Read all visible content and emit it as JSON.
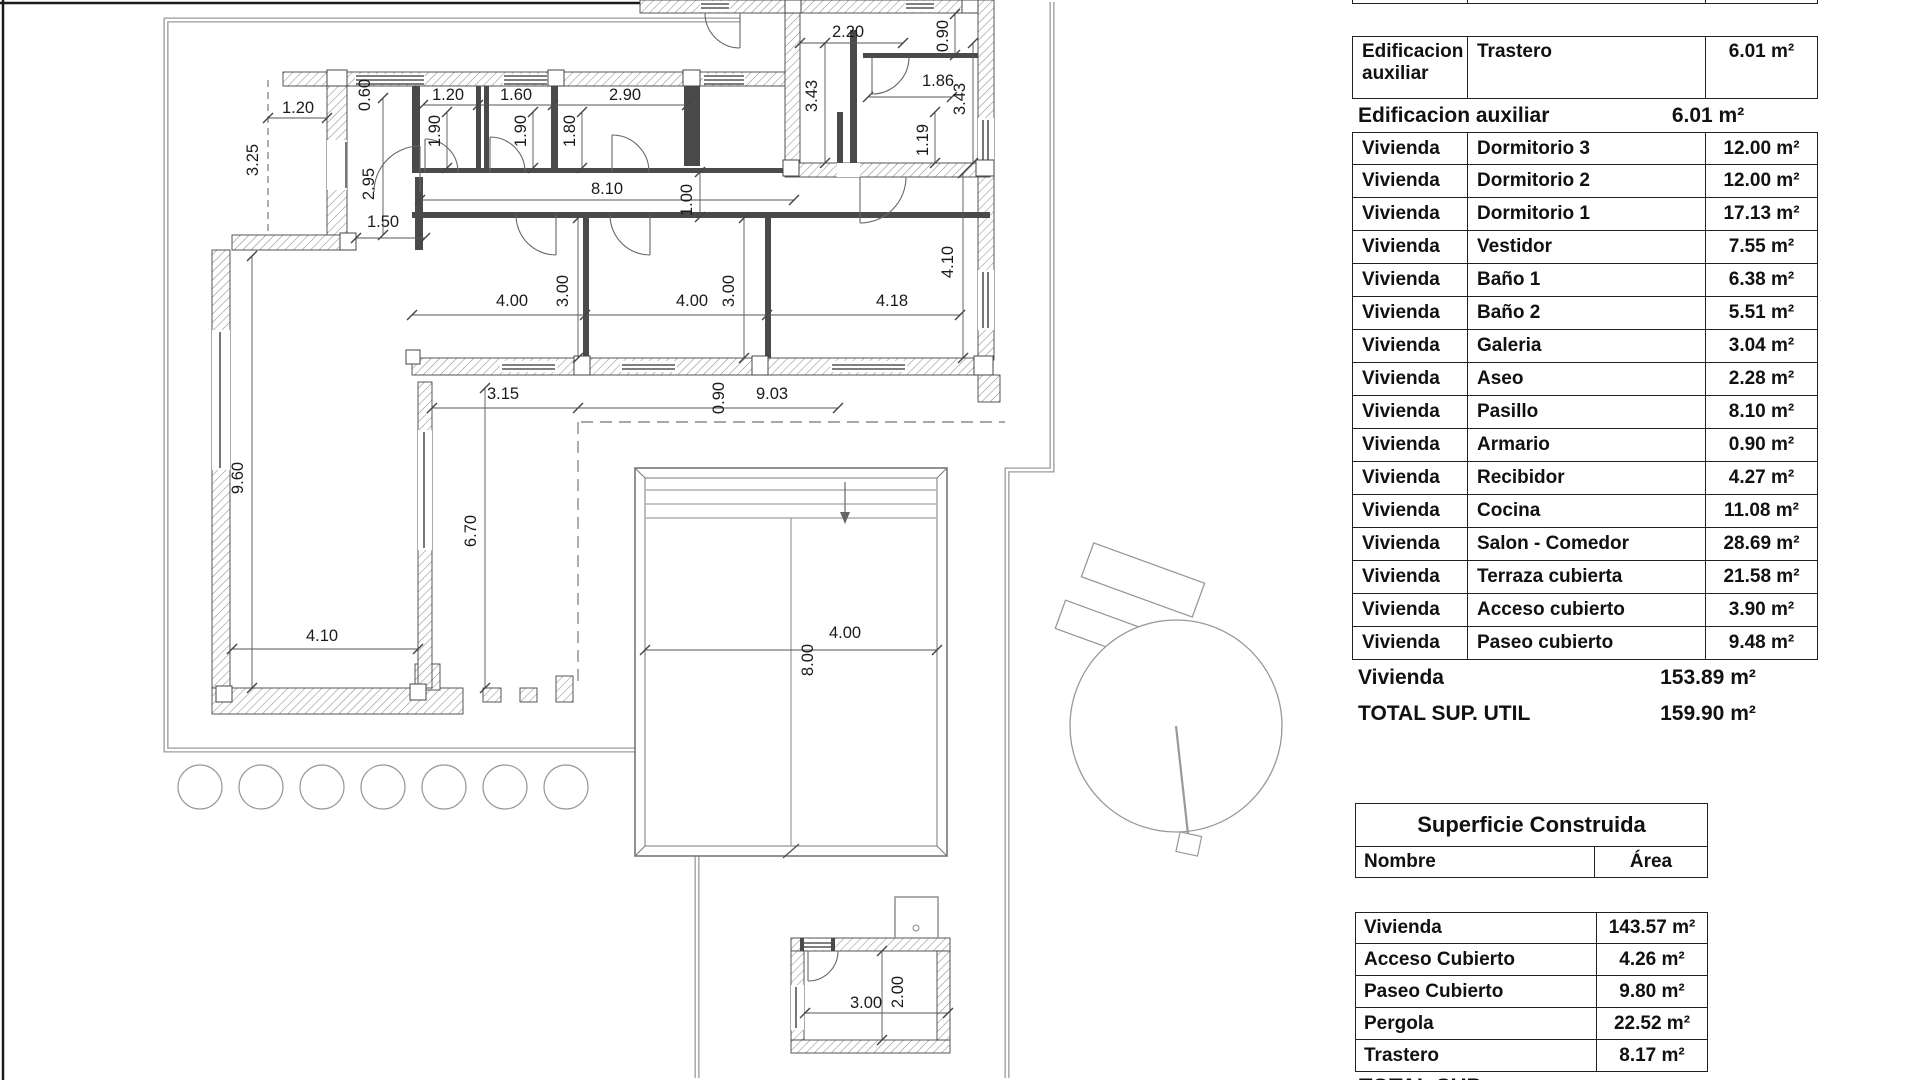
{
  "plan": {
    "dimension_labels": [
      {
        "text": "1.20",
        "x": 298,
        "y": 113,
        "rot": 0
      },
      {
        "text": "3.25",
        "x": 258,
        "y": 160,
        "rot": -90
      },
      {
        "text": "0.60",
        "x": 370,
        "y": 95,
        "rot": -90
      },
      {
        "text": "1.20",
        "x": 448,
        "y": 100,
        "rot": 0
      },
      {
        "text": "1.90",
        "x": 440,
        "y": 131,
        "rot": -90
      },
      {
        "text": "1.60",
        "x": 516,
        "y": 100,
        "rot": 0
      },
      {
        "text": "1.90",
        "x": 526,
        "y": 131,
        "rot": -90
      },
      {
        "text": "1.80",
        "x": 575,
        "y": 131,
        "rot": -90
      },
      {
        "text": "2.90",
        "x": 625,
        "y": 100,
        "rot": 0
      },
      {
        "text": "8.10",
        "x": 607,
        "y": 194,
        "rot": 0
      },
      {
        "text": "1.00",
        "x": 692,
        "y": 200,
        "rot": -90
      },
      {
        "text": "2.20",
        "x": 848,
        "y": 37,
        "rot": 0
      },
      {
        "text": "0.90",
        "x": 948,
        "y": 36,
        "rot": -90
      },
      {
        "text": "3.43",
        "x": 817,
        "y": 96,
        "rot": -90
      },
      {
        "text": "1.86",
        "x": 938,
        "y": 86,
        "rot": 0
      },
      {
        "text": "3.43",
        "x": 965,
        "y": 99,
        "rot": -90
      },
      {
        "text": "1.19",
        "x": 928,
        "y": 140,
        "rot": -90
      },
      {
        "text": "2.95",
        "x": 374,
        "y": 184,
        "rot": -90
      },
      {
        "text": "1.50",
        "x": 383,
        "y": 227,
        "rot": 0
      },
      {
        "text": "4.00",
        "x": 512,
        "y": 306,
        "rot": 0
      },
      {
        "text": "3.00",
        "x": 568,
        "y": 291,
        "rot": -90
      },
      {
        "text": "4.00",
        "x": 692,
        "y": 306,
        "rot": 0
      },
      {
        "text": "3.00",
        "x": 734,
        "y": 291,
        "rot": -90
      },
      {
        "text": "4.18",
        "x": 892,
        "y": 306,
        "rot": 0
      },
      {
        "text": "4.10",
        "x": 953,
        "y": 262,
        "rot": -90
      },
      {
        "text": "3.15",
        "x": 503,
        "y": 399,
        "rot": 0
      },
      {
        "text": "0.90",
        "x": 724,
        "y": 398,
        "rot": -90
      },
      {
        "text": "9.03",
        "x": 772,
        "y": 399,
        "rot": 0
      },
      {
        "text": "9.60",
        "x": 243,
        "y": 478,
        "rot": -90
      },
      {
        "text": "6.70",
        "x": 476,
        "y": 531,
        "rot": -90
      },
      {
        "text": "4.10",
        "x": 322,
        "y": 641,
        "rot": 0
      },
      {
        "text": "4.00",
        "x": 845,
        "y": 638,
        "rot": 0
      },
      {
        "text": "8.00",
        "x": 813,
        "y": 660,
        "rot": -90
      },
      {
        "text": "3.00",
        "x": 866,
        "y": 1008,
        "rot": 0
      },
      {
        "text": "2.00",
        "x": 903,
        "y": 992,
        "rot": -90
      }
    ]
  },
  "tables": {
    "areas_utiles": {
      "header": {
        "col1": "Edificacion",
        "col2": "Nombre",
        "col3": "Área"
      },
      "aux_row": {
        "col1a": "Edificacion",
        "col1b": "auxiliar",
        "col2": "Trastero",
        "col3": "6.01 m²"
      },
      "aux_summary": {
        "label": "Edificacion auxiliar",
        "value": "6.01 m²"
      },
      "rows": [
        {
          "edificacion": "Vivienda",
          "nombre": "Dormitorio 3",
          "area": "12.00 m²"
        },
        {
          "edificacion": "Vivienda",
          "nombre": "Dormitorio 2",
          "area": "12.00 m²"
        },
        {
          "edificacion": "Vivienda",
          "nombre": "Dormitorio 1",
          "area": "17.13 m²"
        },
        {
          "edificacion": "Vivienda",
          "nombre": "Vestidor",
          "area": "7.55 m²"
        },
        {
          "edificacion": "Vivienda",
          "nombre": "Baño 1",
          "area": "6.38 m²"
        },
        {
          "edificacion": "Vivienda",
          "nombre": "Baño 2",
          "area": "5.51 m²"
        },
        {
          "edificacion": "Vivienda",
          "nombre": "Galeria",
          "area": "3.04 m²"
        },
        {
          "edificacion": "Vivienda",
          "nombre": "Aseo",
          "area": "2.28 m²"
        },
        {
          "edificacion": "Vivienda",
          "nombre": "Pasillo",
          "area": "8.10 m²"
        },
        {
          "edificacion": "Vivienda",
          "nombre": "Armario",
          "area": "0.90 m²"
        },
        {
          "edificacion": "Vivienda",
          "nombre": "Recibidor",
          "area": "4.27 m²"
        },
        {
          "edificacion": "Vivienda",
          "nombre": "Cocina",
          "area": "11.08 m²"
        },
        {
          "edificacion": "Vivienda",
          "nombre": "Salon - Comedor",
          "area": "28.69 m²"
        },
        {
          "edificacion": "Vivienda",
          "nombre": "Terraza cubierta",
          "area": "21.58 m²"
        },
        {
          "edificacion": "Vivienda",
          "nombre": "Acceso cubierto",
          "area": "3.90 m²"
        },
        {
          "edificacion": "Vivienda",
          "nombre": "Paseo cubierto",
          "area": "9.48 m²"
        }
      ],
      "vivienda_summary": {
        "label": "Vivienda",
        "value": "153.89 m²"
      },
      "total": {
        "label": "TOTAL SUP. UTIL",
        "value": "159.90 m²"
      }
    },
    "superficie_construida": {
      "title": "Superficie Construida",
      "header": {
        "col1": "Nombre",
        "col2": "Área"
      },
      "rows": [
        {
          "nombre": "Vivienda",
          "area": "143.57 m²"
        },
        {
          "nombre": "Acceso Cubierto",
          "area": "4.26 m²"
        },
        {
          "nombre": "Paseo Cubierto",
          "area": "9.80 m²"
        },
        {
          "nombre": "Pergola",
          "area": "22.52 m²"
        },
        {
          "nombre": "Trastero",
          "area": "8.17 m²"
        }
      ],
      "total": {
        "label": "TOTAL SUP. CONSTRUIDA",
        "value": "188.32 m²"
      }
    }
  }
}
